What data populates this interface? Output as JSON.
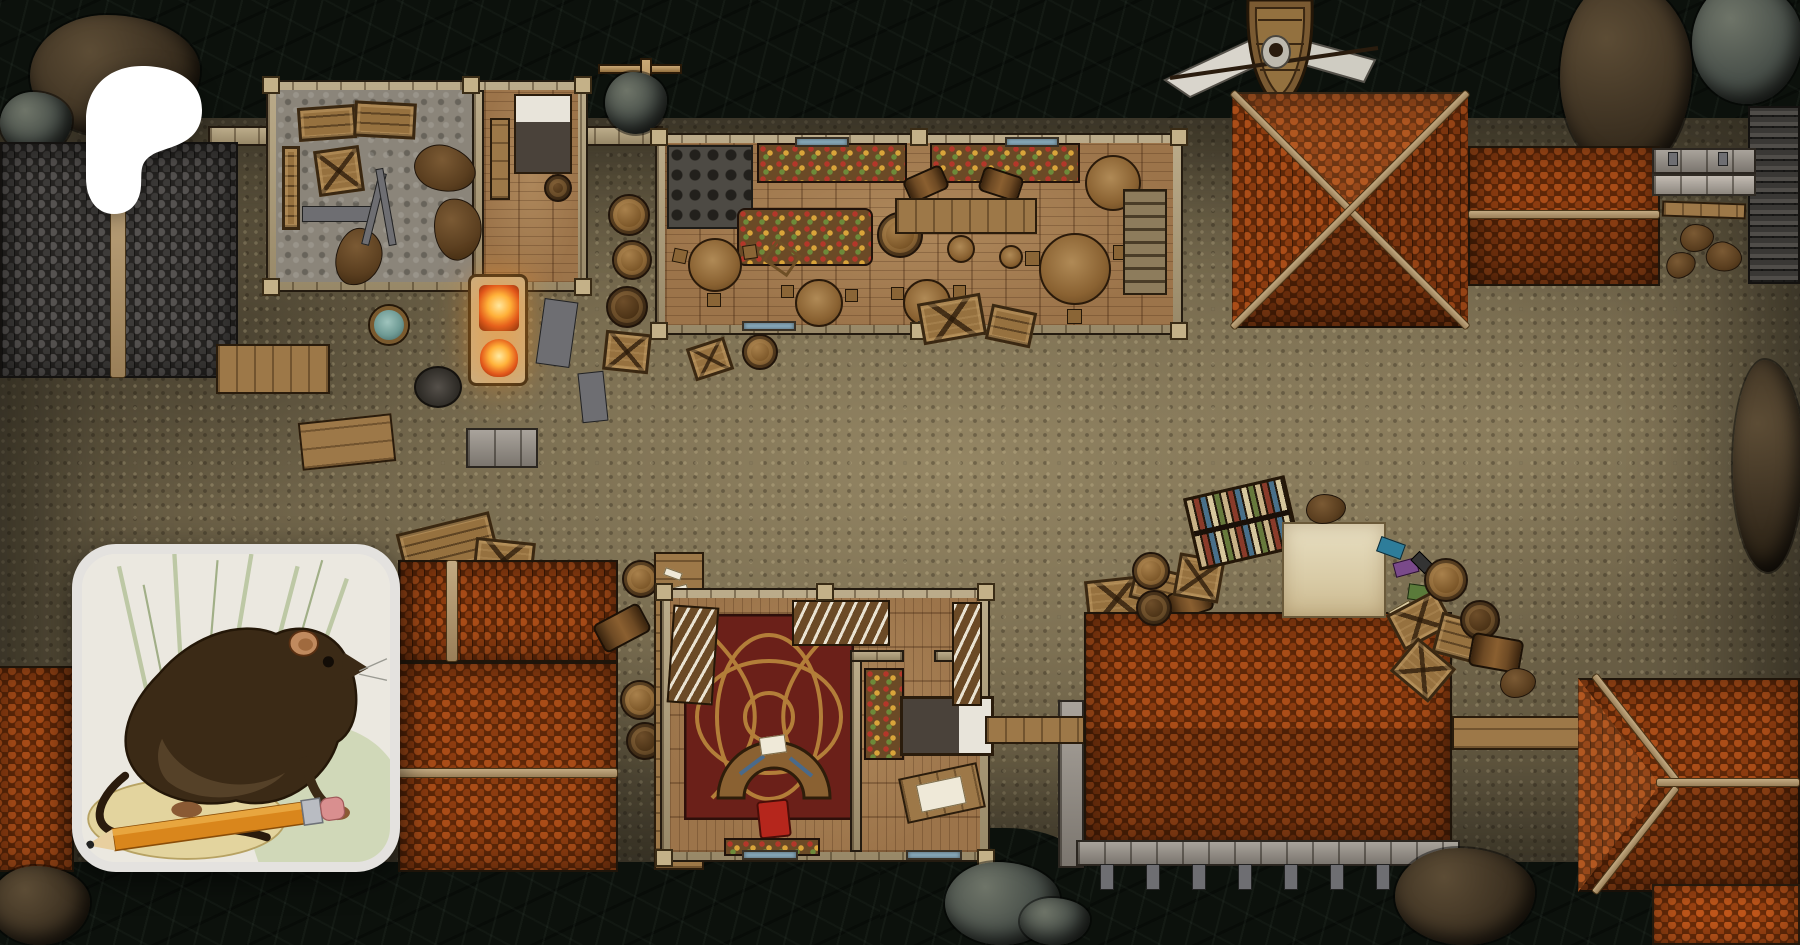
{
  "overlay": {
    "logo": {
      "icon": "patreon-logo",
      "color": "#ffffff"
    },
    "avatar": {
      "icon": "creator-avatar",
      "subject": "vintage rat illustration with orange pencil",
      "border_color": "#e4e2df"
    }
  },
  "map": {
    "kind": "top-down fantasy harbor street battlemap",
    "palette": {
      "water": "#0c110c",
      "ground": "#695e45",
      "road_highlight": "#94875f",
      "roof_orange_light": "#aa4d18",
      "roof_orange_dark": "#5e2708",
      "roof_slate": "#4a4744",
      "wall_stone": "#b2a07a",
      "wood_floor": "#9c744a",
      "carpet_red": "#6b2019",
      "carpet_gold": "#c08f3f",
      "awning_canvas": "#ddd2b2",
      "fire": "#ff9a2e",
      "window_glass": "#8fb2c4"
    },
    "features": {
      "water": "dark harbor water",
      "street": "gravel village street",
      "slate_roof": "slate-tiled roof",
      "storage_house": "storage room and small bedroom",
      "forge_yard": "open-air forge with furnace, quench tub, firepit and benches",
      "tavern": "tavern hall with bar table, round tables, kitchen and stairs",
      "hip_roof": "hipped clay-tile roof",
      "gable_roof": "clay-tile gable roof",
      "corner_slate_roof": "slate pavilion roof",
      "stone_pier": "stone pier with bench and sacks",
      "ship": "moored sailing ship with spread sails",
      "book_stall": "street book stall with shelf, awning and scattered books",
      "study_house": "study with red knotwork carpet, crescent desk and bedroom",
      "warehouse": "clay-tile warehouse on a stone pier over water",
      "corner_house": "hip-roofed waterfront house",
      "bridge": "wooden dock bridge",
      "crane": "dockside hoist crane",
      "barrel": "barrel",
      "crate": "crate",
      "rock": "rock outcrop"
    }
  }
}
